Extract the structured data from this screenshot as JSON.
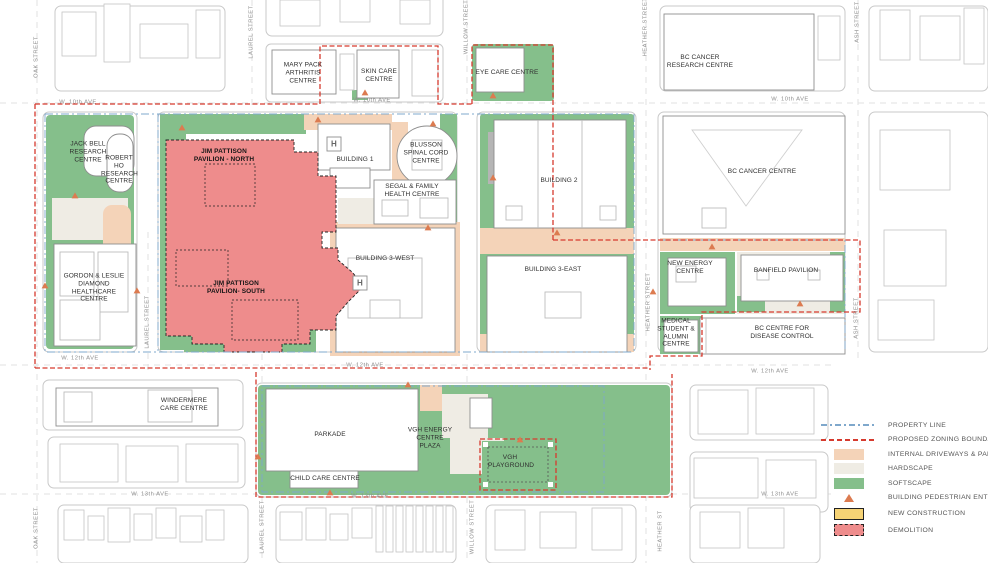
{
  "title": "VGH Campus Site Plan",
  "streets": {
    "oak": "OAK STREET",
    "laurel": "LAUREL STREET",
    "willow": "WILLOW STREET",
    "heather": "HEATHER STREET",
    "heather_short": "HEATHER ST",
    "ash": "ASH STREET"
  },
  "avenues": {
    "ave10": "W. 10th AVE",
    "ave12": "W. 12th AVE",
    "ave13": "W. 13th AVE"
  },
  "buildings": {
    "jack_bell": "JACK BELL RESEARCH CENTRE",
    "robert_ho": "ROBERT HO RESEARCH CENTRE",
    "diamond": "GORDON & LESLIE DIAMOND HEALTHCARE CENTRE",
    "mary_pack": "MARY PACK ARTHRITIS CENTRE",
    "skin_care": "SKIN CARE CENTRE",
    "eye_care": "EYE CARE CENTRE",
    "bc_cancer_research": "BC CANCER RESEARCH CENTRE",
    "jp_north": "JIM PATTISON PAVILION - NORTH",
    "jp_south": "JIM PATTISON PAVILION- SOUTH",
    "building1": "BUILDING 1",
    "blusson": "BLUSSON SPINAL CORD CENTRE",
    "segal": "SEGAL & FAMILY HEALTH CENTRE",
    "building3w": "BUILDING 3-WEST",
    "building2": "BUILDING 2",
    "building3e": "BUILDING 3-EAST",
    "bc_cancer_centre": "BC CANCER CENTRE",
    "new_energy": "NEW ENERGY CENTRE",
    "banfield": "BANFIELD PAVILION",
    "med_student": "MEDICAL STUDENT & ALUMNI CENTRE",
    "bccdc": "BC CENTRE FOR DISEASE CONTROL",
    "windermere": "WINDERMERE CARE CENTRE",
    "parkade": "PARKADE",
    "child_care": "CHILD CARE CENTRE",
    "vgh_energy_plaza": "VGH ENERGY CENTRE PLAZA",
    "vgh_playground": "VGH PLAYGROUND"
  },
  "icons": {
    "helipad": "H",
    "pedestrian_entrance": "triangle"
  },
  "legend": {
    "items": [
      {
        "label": "PROPERTY LINE",
        "color": "#7FA8CC"
      },
      {
        "label": "PROPOSED ZONING BOUNDARY",
        "color": "#D63A2E"
      },
      {
        "label": "INTERNAL DRIVEWAYS & PARKING",
        "color": "#F4D3B8"
      },
      {
        "label": "HARDSCAPE",
        "color": "#EFECE4"
      },
      {
        "label": "SOFTSCAPE",
        "color": "#85BF8B"
      },
      {
        "label": "BUILDING PEDESTRIAN ENTRANCE",
        "color": "#DC7B50"
      },
      {
        "label": "NEW CONSTRUCTION",
        "color": "#F6D375"
      },
      {
        "label": "DEMOLITION",
        "color": "#EE8C8C"
      }
    ]
  }
}
